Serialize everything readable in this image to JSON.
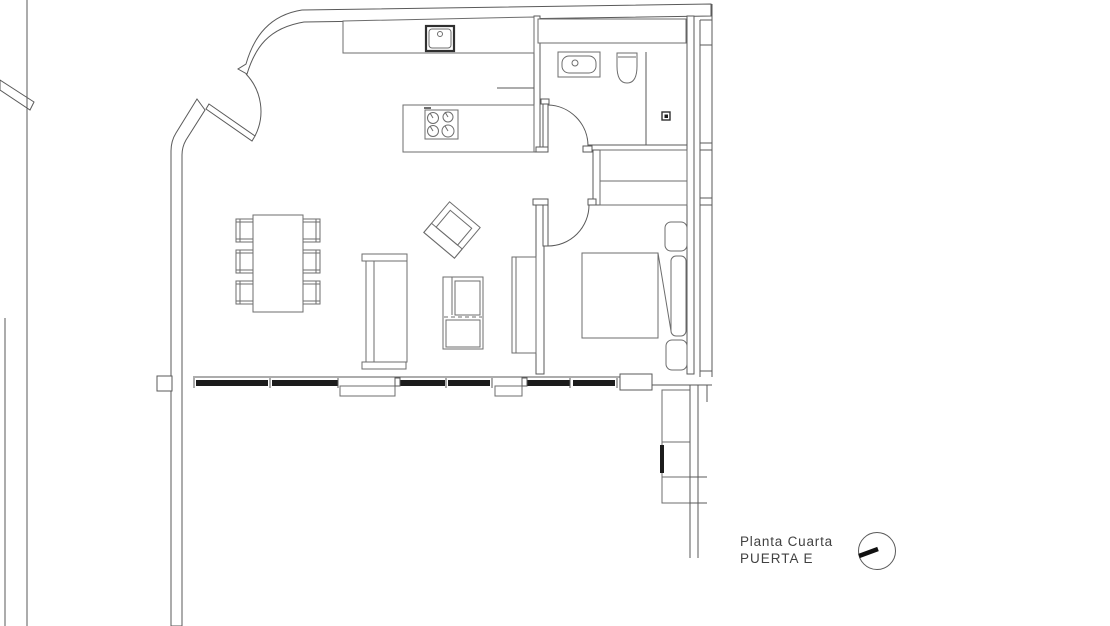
{
  "title_block": {
    "line1": "Planta Cuarta",
    "line2": "PUERTA E"
  },
  "icons": {
    "orientation_dial": "circle-with-clock-hand"
  },
  "colors": {
    "background": "#ffffff",
    "wall_line": "#5a5a5a",
    "furniture_line": "#6d6d6d",
    "dark_line": "#303030",
    "window_glazing": "#1c1c1c",
    "label_text": "#414141"
  }
}
